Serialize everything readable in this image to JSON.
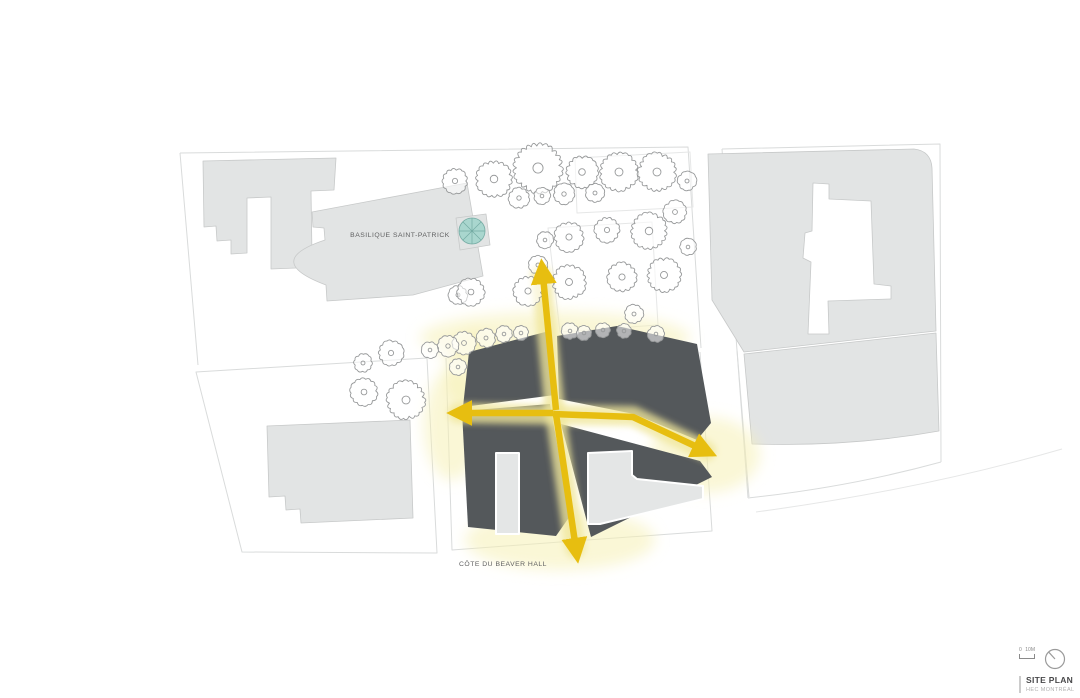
{
  "labels": {
    "basilica": "BASILIQUE SAINT-PATRICK",
    "street": "CÔTE DU BEAVER HALL"
  },
  "title_block": {
    "title": "SITE PLAN",
    "subtitle": "HEC MONTRÉAL",
    "scale_zero": "0",
    "scale_label": "10M"
  },
  "colors": {
    "dark_building": "#54585B",
    "light_building": "#E2E4E4",
    "building_stroke": "#C7C9C9",
    "parcel_line": "#D9DBDB",
    "faint_line": "#E6E7E7",
    "arrow": "#E7BE10",
    "arrow_glow": "#F0E79B",
    "glow_blob": "#F6F0B4",
    "tree_stroke": "#97999A",
    "dome_fill": "#A9D6CE",
    "dome_stroke": "#74ABA3",
    "label_text": "#5F5F60",
    "title_text": "#48484A",
    "subtitle_text": "#B0B0B0",
    "scale_text": "#8A8A8A",
    "icon_stroke": "#9A9A9A"
  }
}
